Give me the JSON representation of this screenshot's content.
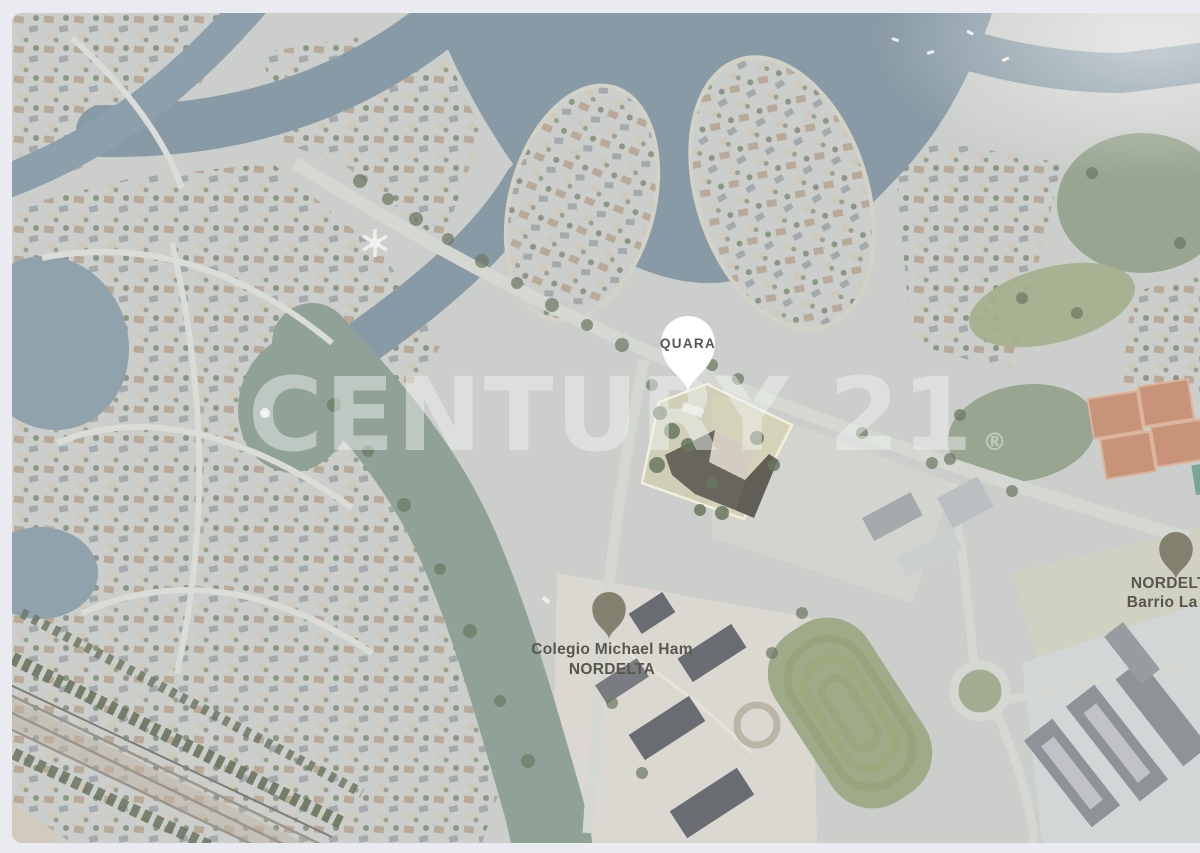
{
  "viewer": {
    "background": "#e9ebf0"
  },
  "map": {
    "watermark": {
      "text": "CENTURY 21",
      "registered": "®",
      "color": "rgba(238,242,240,0.47)"
    },
    "markers": {
      "quara": {
        "label": "QUARA"
      },
      "colegio": {
        "line1": "Colegio Michael Ham",
        "line2": "NORDELTA"
      },
      "barrio": {
        "line1": "NORDELTA",
        "line2": "Barrio La Isla"
      }
    },
    "colors": {
      "water": "#7b8f9b",
      "lagoon": "#84978c",
      "land": "#c6c9c5",
      "field": "#95a17c",
      "tennis_clay": "#c2886a",
      "parcel_fill": "rgba(215,205,95,0.22)",
      "parcel_outline": "#f2eeda",
      "pin_white": "#ffffff",
      "pin_dark": "#6e6a58",
      "label_color": "#474439"
    }
  }
}
